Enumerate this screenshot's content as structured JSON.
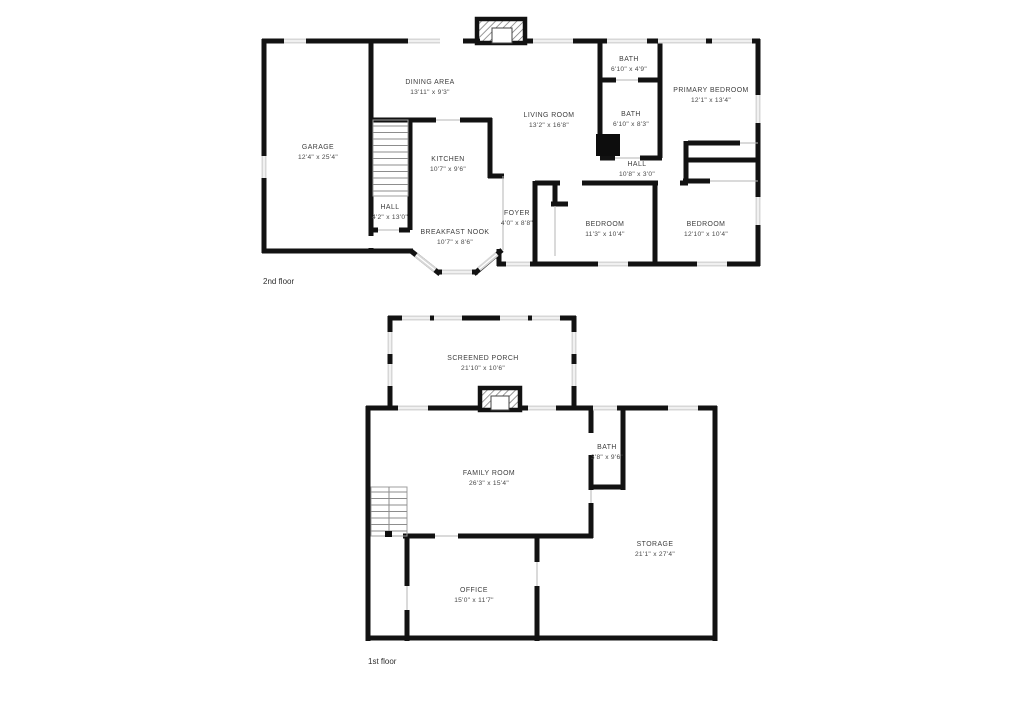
{
  "colors": {
    "wall": "#121212",
    "window": "#d7d7d7",
    "background": "#ffffff",
    "text": "#3e3e3e"
  },
  "floors": {
    "second": {
      "label": "2nd floor",
      "rooms": {
        "garage": {
          "name": "GARAGE",
          "dims": "12'4\" x 25'4\""
        },
        "dining": {
          "name": "DINING AREA",
          "dims": "13'11\" x 9'3\""
        },
        "living": {
          "name": "LIVING ROOM",
          "dims": "13'2\" x 16'8\""
        },
        "bath_top": {
          "name": "BATH",
          "dims": "6'10\" x 4'9\""
        },
        "bath_mid": {
          "name": "BATH",
          "dims": "6'10\" x 8'3\""
        },
        "primary": {
          "name": "PRIMARY BEDROOM",
          "dims": "12'1\" x 13'4\""
        },
        "kitchen": {
          "name": "KITCHEN",
          "dims": "10'7\" x 9'6\""
        },
        "hall_upper": {
          "name": "HALL",
          "dims": "10'8\" x 3'0\""
        },
        "hall_lower": {
          "name": "HALL",
          "dims": "4'2\" x 13'0\""
        },
        "breakfast": {
          "name": "BREAKFAST NOOK",
          "dims": "10'7\" x 8'6\""
        },
        "foyer": {
          "name": "FOYER",
          "dims": "4'0\" x 8'8\""
        },
        "bedroom1": {
          "name": "BEDROOM",
          "dims": "11'3\" x 10'4\""
        },
        "bedroom2": {
          "name": "BEDROOM",
          "dims": "12'10\" x 10'4\""
        }
      }
    },
    "first": {
      "label": "1st floor",
      "rooms": {
        "porch": {
          "name": "SCREENED PORCH",
          "dims": "21'10\" x 10'6\""
        },
        "family": {
          "name": "FAMILY ROOM",
          "dims": "26'3\" x 15'4\""
        },
        "bath": {
          "name": "BATH",
          "dims": "3'8\" x 9'6\""
        },
        "storage": {
          "name": "STORAGE",
          "dims": "21'1\" x 27'4\""
        },
        "office": {
          "name": "OFFICE",
          "dims": "15'0\" x 11'7\""
        }
      }
    }
  }
}
